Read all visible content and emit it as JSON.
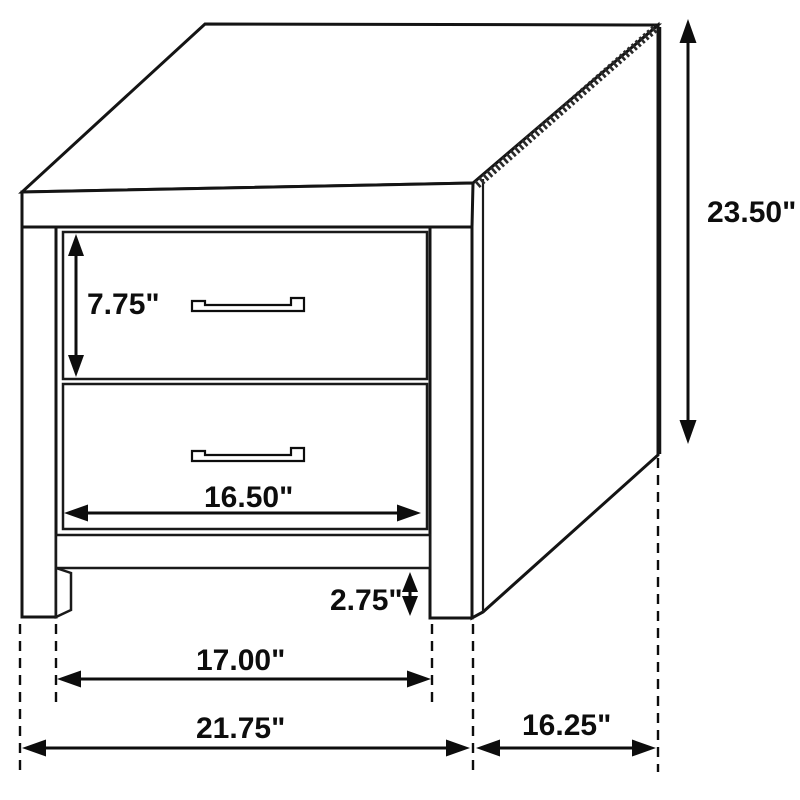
{
  "diagram": {
    "subject": "2-drawer nightstand isometric line drawing with dimensions",
    "unit_symbol": "\"",
    "dimensions": {
      "overall_height": {
        "label": "23.50\"",
        "value": 23.5
      },
      "drawer_height": {
        "label": "7.75\"",
        "value": 7.75
      },
      "drawer_width": {
        "label": "16.50\"",
        "value": 16.5
      },
      "floor_clearance": {
        "label": "2.75\"",
        "value": 2.75
      },
      "opening_width": {
        "label": "17.00\"",
        "value": 17.0
      },
      "overall_width": {
        "label": "21.75\"",
        "value": 21.75
      },
      "depth": {
        "label": "16.25\"",
        "value": 16.25
      }
    }
  }
}
